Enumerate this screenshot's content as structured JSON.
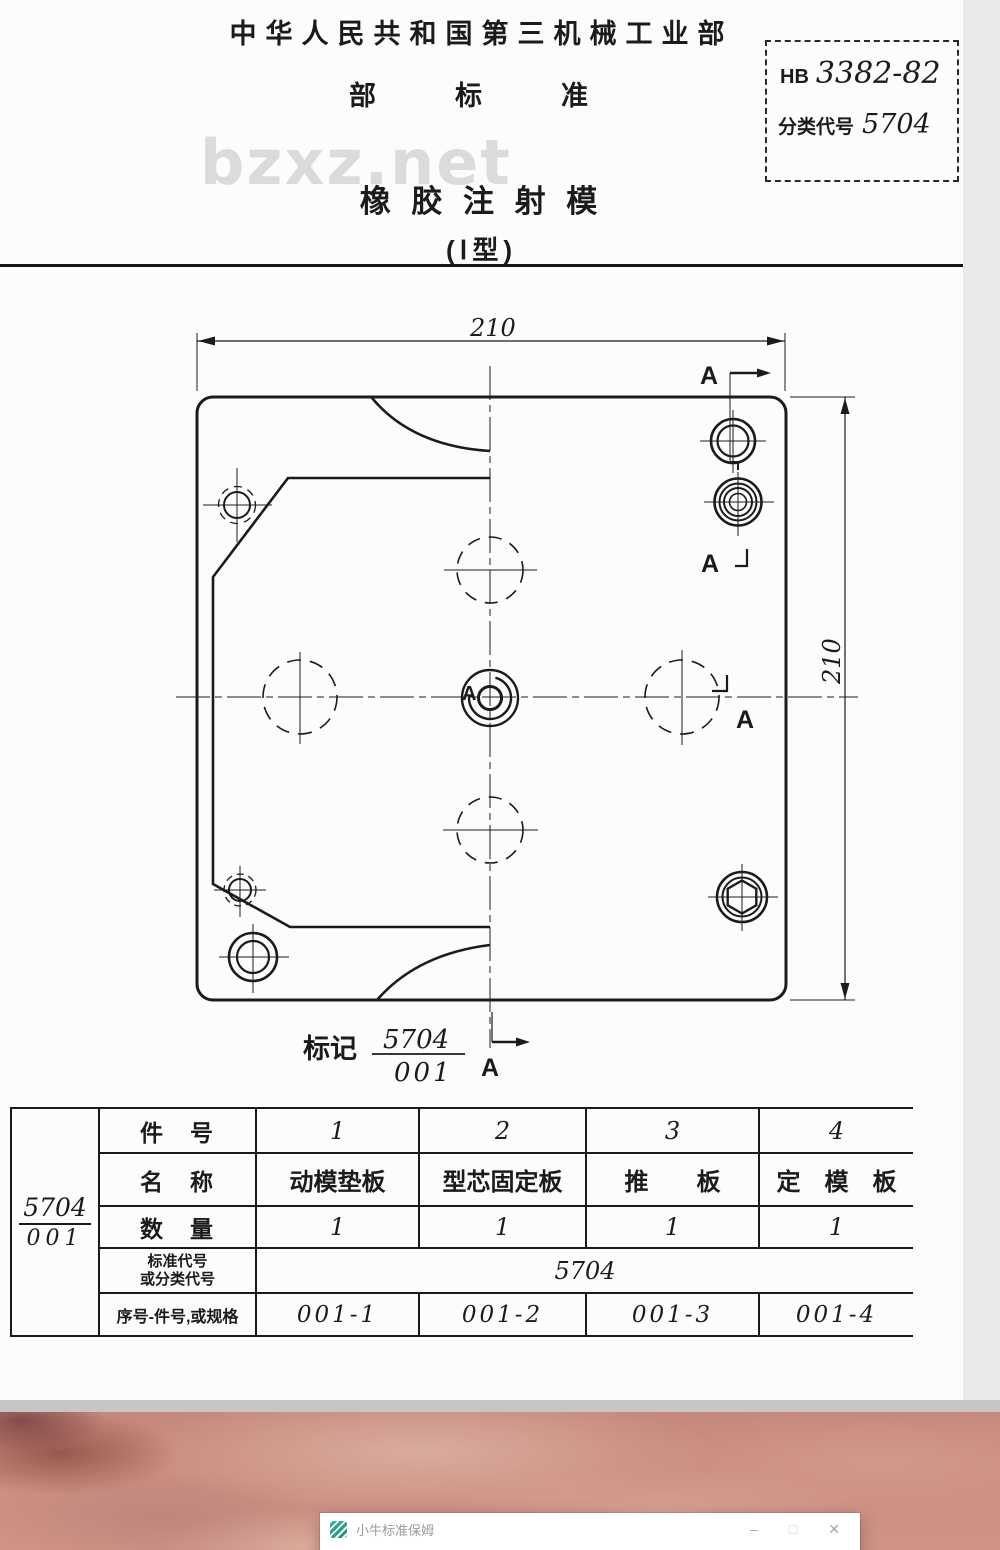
{
  "header": {
    "ministry": "中华人民共和国第三机械工业部",
    "std_type": "部　标　准",
    "code_prefix": "HB",
    "code_number": "3382-82",
    "class_label": "分类代号",
    "class_code": "5704",
    "title": "橡 胶 注 射 模",
    "subtitle": "(Ⅰ型)",
    "watermark": "bzxz.net"
  },
  "drawing": {
    "dim_top": "210",
    "dim_right": "210",
    "section_label": "A",
    "center_label": "A",
    "mark_label": "标记",
    "mark_code_num": "5704",
    "mark_code_den": "001"
  },
  "parts_table": {
    "side_num": "5704",
    "side_den": "001",
    "row_headers": {
      "part_no": "件　号",
      "name": "名　称",
      "qty": "数　量",
      "std_line1": "标准代号",
      "std_line2": "或分类代号",
      "spec": "序号-件号,或规格"
    },
    "std_code": "5704",
    "columns": [
      {
        "no": "1",
        "name": "动模垫板",
        "qty": "1",
        "spec": "001-1"
      },
      {
        "no": "2",
        "name": "型芯固定板",
        "qty": "1",
        "spec": "001-2"
      },
      {
        "no": "3",
        "name": "推　　板",
        "qty": "1",
        "spec": "001-3"
      },
      {
        "no": "4",
        "name": "定　模　板",
        "qty": "1",
        "spec": "001-4"
      }
    ]
  },
  "app_window": {
    "title": "小牛标准保姆",
    "menu": "菜单",
    "controls": {
      "minimize": "–",
      "maximize": "□",
      "close": "✕"
    }
  },
  "colors": {
    "line": "#1b1b1b",
    "page_bg": "#fcfcfb",
    "watermark": "#dbdbdb",
    "gray_band": "#c6c6c6",
    "wallpaper_base": "#cd8b7c",
    "window_icon": "#2e9e8f"
  }
}
